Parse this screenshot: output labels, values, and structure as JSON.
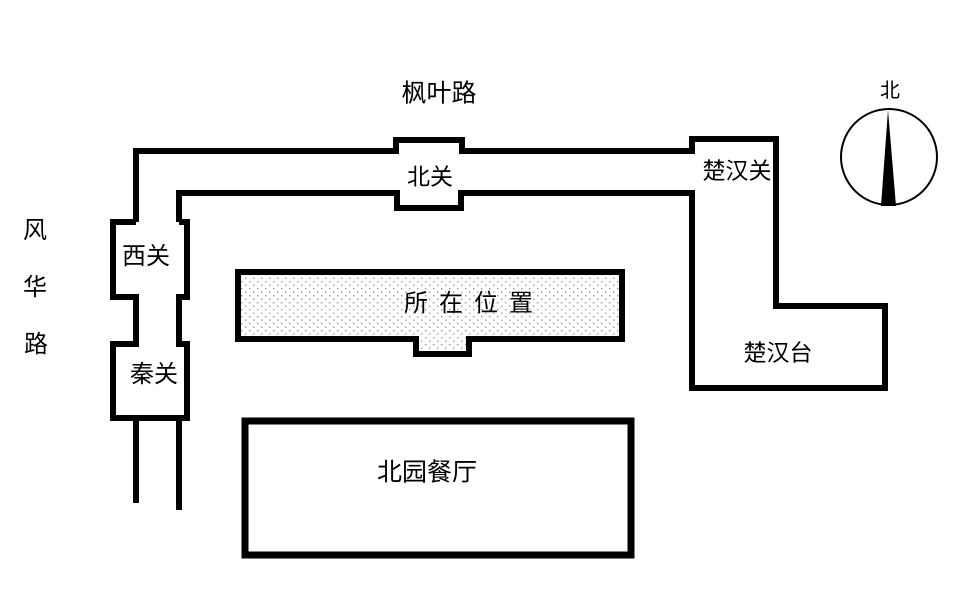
{
  "map": {
    "roads": {
      "top_road_label": "枫叶路",
      "left_road_chars": [
        "风",
        "华",
        "路"
      ]
    },
    "gates": {
      "north_gate_label": "北关",
      "west_gate_label": "西关",
      "qin_gate_label": "秦关",
      "chuhan_gate_label": "楚汉关"
    },
    "places": {
      "current_location_label": "所在位置",
      "chuhan_platform_label": "楚汉台",
      "restaurant_label": "北园餐厅"
    },
    "compass": {
      "north_label": "北"
    },
    "colors": {
      "line": "#000000",
      "background": "#ffffff",
      "stipple_dot": "#999999"
    }
  }
}
